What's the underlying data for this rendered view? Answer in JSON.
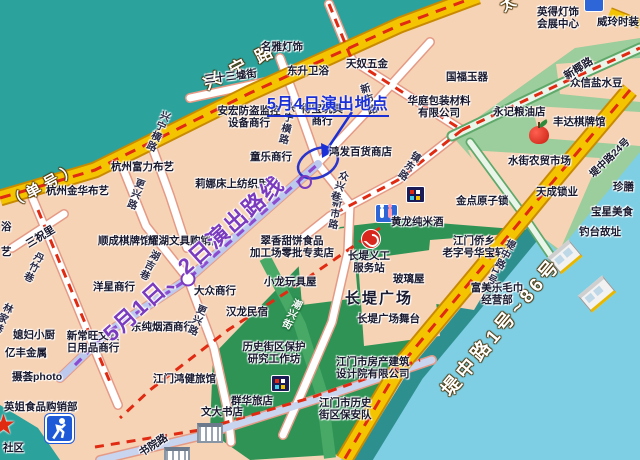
{
  "annotations": {
    "may4_location": "5月4日演出地点",
    "may12_route": "5月1日、2日演出路线"
  },
  "roads": {
    "xingning": "兴宁路",
    "xingning_note": "（单号）",
    "taiping_partial": "太",
    "dizhong_range": "堤中路1号~86号"
  },
  "streets": [
    "三十三墟街",
    "兴宁横路",
    "更兴路",
    "三祝里",
    "丹竹巷",
    "林家巷",
    "湖吉巷",
    "新市路",
    "众兴巷",
    "镇东路",
    "书院路",
    "潮兴街",
    "新椰路",
    "堤中路24号",
    "堤中路1号"
  ],
  "pois": [
    "名雅灯饰",
    "东升卫浴",
    "天奴五金",
    "英得灯饰\n会展中心",
    "威玲时装",
    "国福玉器",
    "安宏防盗监控\n设备商行",
    "得宝玩具\n商行",
    "华庭包装材料\n有限公司",
    "永记粮油店",
    "众信盐水豆",
    "丰达棋牌馆",
    "杭州富力布艺",
    "杭州金华布艺",
    "童乐商行",
    "莉娜床上纺织用品",
    "鸿发百货商店",
    "水街农贸市场",
    "天成锁业",
    "珍膳",
    "宝星美食",
    "金点原子锁",
    "钓台故址",
    "富美乐毛巾\n经营部",
    "江门侨乡\n老字号华宝轩",
    "长堤义工\n服务站",
    "玻璃屋",
    "长堤广场",
    "长堤广场舞台",
    "江门市房产建筑\n设计院有限公司",
    "江门市历史\n街区保安队",
    "翠香甜饼食品\n加工场零批专卖店",
    "小龙玩具屋",
    "汉龙民宿",
    "大众商行",
    "洋星商行",
    "顺成棋牌馆",
    "耀湖文具购销部",
    "东纯烟酒商行",
    "媳妇小厨",
    "新常旺文具\n日用品商行",
    "亿丰金属",
    "摄荟photo",
    "英姐食品购销部",
    "江门鸿健旅馆",
    "历史街区保护\n研究工作坊",
    "群华旅店",
    "文大书店",
    "黄龙纯米酒",
    "社区",
    "浴",
    "艺"
  ],
  "icons": [
    "toilet-icon",
    "arcade-icon",
    "apple-icon",
    "volunteer-icon",
    "star-icon",
    "runner-icon",
    "bus-stop-icon",
    "gate-icon",
    "performance-spot-circle",
    "route-point-circle"
  ],
  "colors": {
    "water_top": "#2BA29C",
    "river": "#7ECFE4",
    "land": "#F6D3B5",
    "road_yellow": "#F4C400",
    "road_border": "#C98A00",
    "dash_red": "#E02A12",
    "green_plaza": "#2F9355",
    "green_light": "#9CCD9C",
    "route_purple": "#8A4BD0",
    "annotation_blue": "#1A2FD6"
  }
}
